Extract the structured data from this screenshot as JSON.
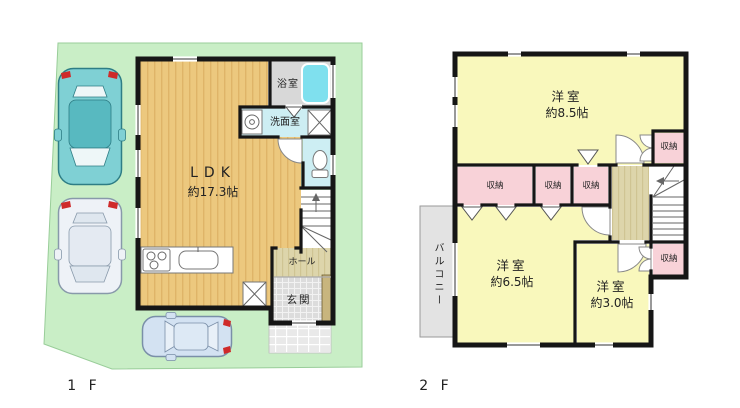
{
  "colors": {
    "c-site": "#c9eec6",
    "c-site-edge": "#99cd99",
    "c-wall": "#161616",
    "c-wood": "#ecc87e",
    "c-wood-stripe": "#dfb468",
    "c-hallfloor": "#ddd5ab",
    "c-hallfloor-stripe": "#cfc493",
    "c-yellow": "#f9f8bc",
    "c-pink": "#f8d2d8",
    "c-cyan-floor": "#cdeef3",
    "c-bath-floor": "#d8d8d8",
    "c-tub": "#7fe0ee",
    "c-genkan": "#dcdcdc",
    "c-porch": "#e9e9e9",
    "c-balcony": "#e3e3e3",
    "c-red": "#cf2a2a",
    "c-text": "#222222"
  },
  "floor1": {
    "floor_label": "1 F",
    "ldk_name": "LDK",
    "ldk_area": "約17.3帖",
    "bathroom_label": "浴室",
    "washroom_label": "洗面室",
    "hall_label": "ホール",
    "entrance_label": "玄関"
  },
  "floor2": {
    "floor_label": "2 F",
    "bedroom85_name": "洋室",
    "bedroom85_area": "約8.5帖",
    "bedroom65_name": "洋室",
    "bedroom65_area": "約6.5帖",
    "bedroom30_name": "洋室",
    "bedroom30_area": "約3.0帖",
    "balcony_label": "バルコニー",
    "closet_label": "収納"
  }
}
